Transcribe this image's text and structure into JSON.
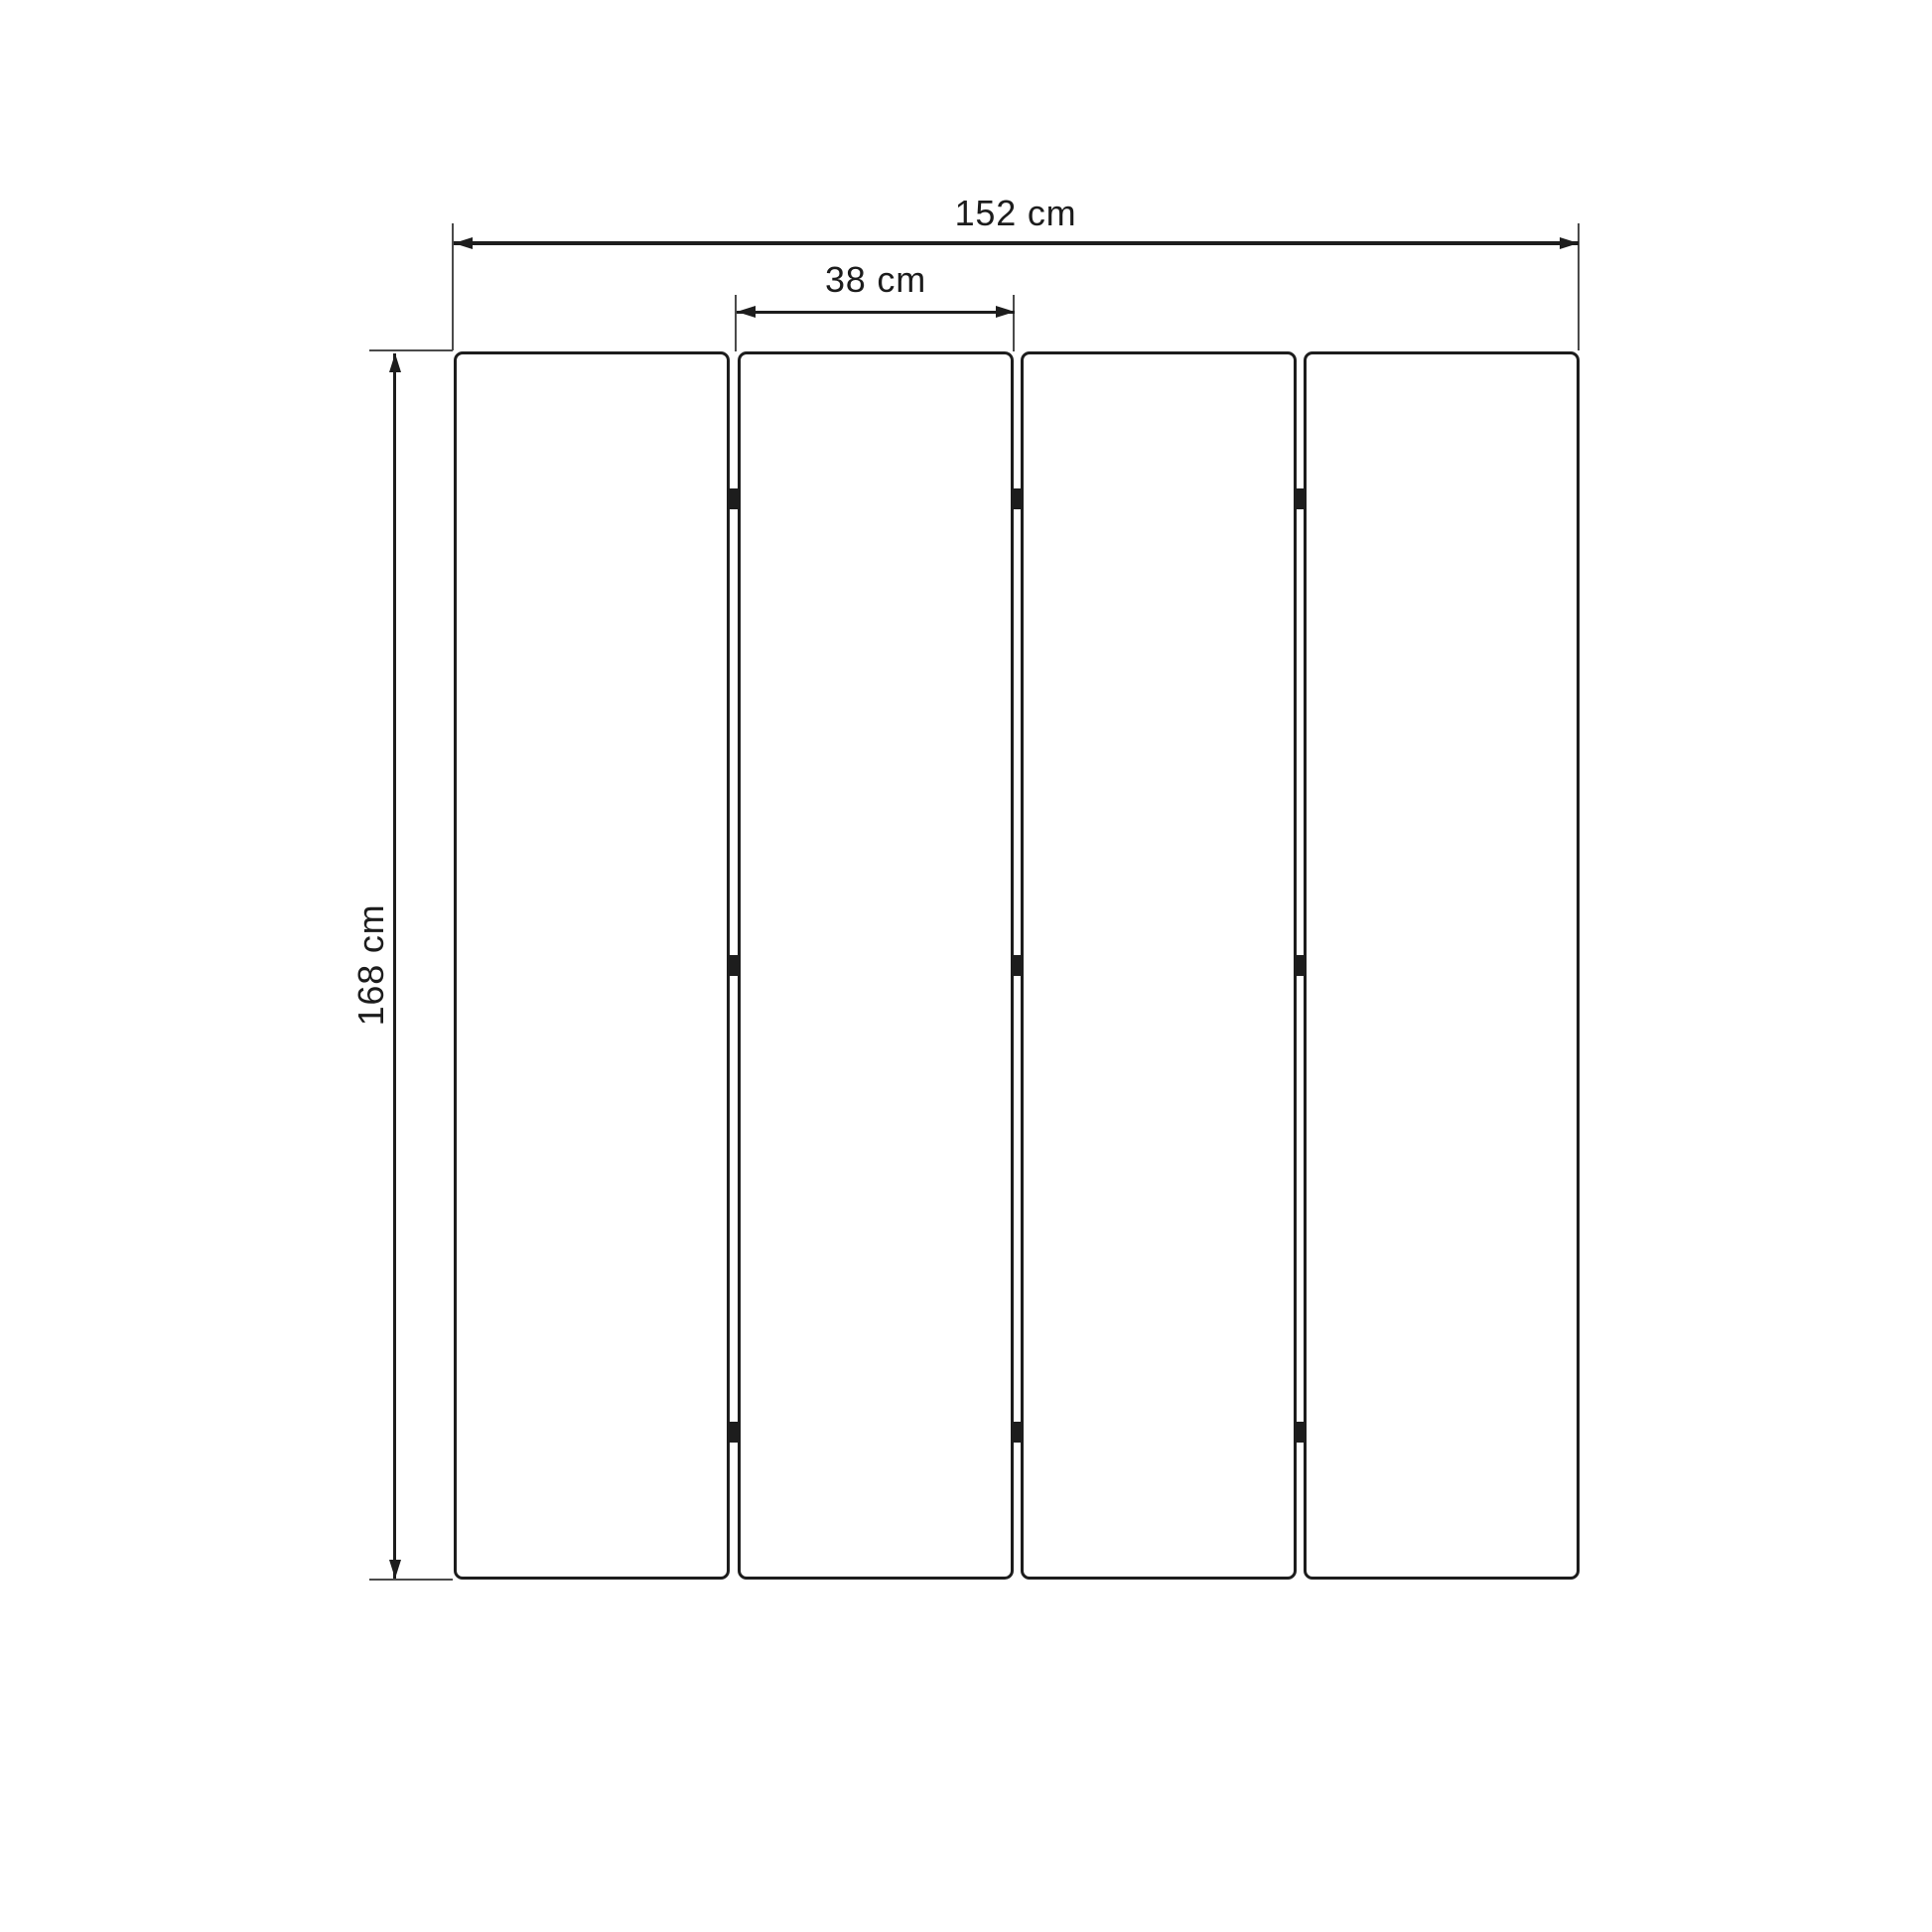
{
  "diagram": {
    "kind": "dimension-drawing",
    "panel_count": 4,
    "hinge_rows": 3,
    "colors": {
      "line": "#1d1d1d",
      "extension_line": "#4a4a4a",
      "background": "#ffffff",
      "panel_fill": "#ffffff"
    },
    "dimensions": {
      "total_width": {
        "label": "152 cm",
        "value": 152,
        "unit": "cm"
      },
      "single_panel_width": {
        "label": "38 cm",
        "value": 38,
        "unit": "cm"
      },
      "height": {
        "label": "168 cm",
        "value": 168,
        "unit": "cm"
      }
    }
  }
}
